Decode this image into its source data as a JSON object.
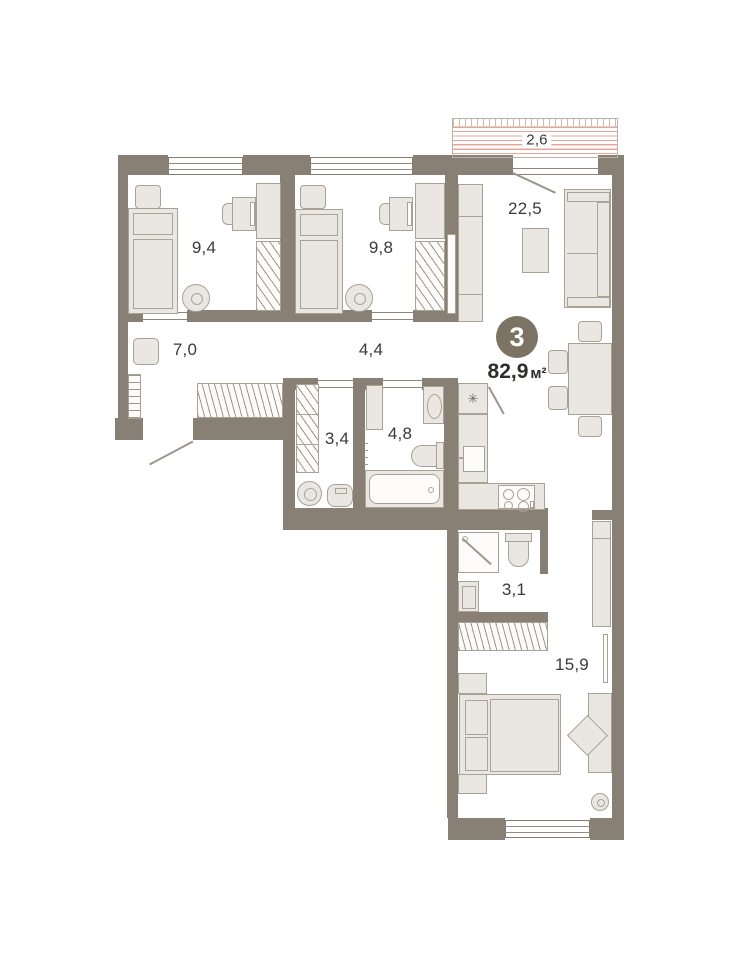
{
  "plan": {
    "title": "3-room apartment floor plan",
    "badge": {
      "rooms_count": "3"
    },
    "total_area": {
      "value": "82,9",
      "unit": "м²"
    },
    "rooms": [
      {
        "name": "bedroom-1",
        "area": "9,4"
      },
      {
        "name": "bedroom-2",
        "area": "9,8"
      },
      {
        "name": "living-kitchen",
        "area": "22,5"
      },
      {
        "name": "hallway",
        "area": "7,0"
      },
      {
        "name": "corridor",
        "area": "4,4"
      },
      {
        "name": "wc",
        "area": "3,4"
      },
      {
        "name": "bathroom",
        "area": "4,8"
      },
      {
        "name": "shower-room",
        "area": "3,1"
      },
      {
        "name": "bedroom-3",
        "area": "15,9"
      },
      {
        "name": "balcony",
        "area": "2,6"
      }
    ],
    "icons": {
      "fridge": "✳"
    },
    "colors": {
      "wall": "#888074",
      "furniture_fill": "#eae6e1",
      "furniture_line": "#a8a196",
      "balcony_hatch": "#e8a69b",
      "badge_bg": "#7c7365",
      "label_text": "#3a3a3a"
    }
  }
}
